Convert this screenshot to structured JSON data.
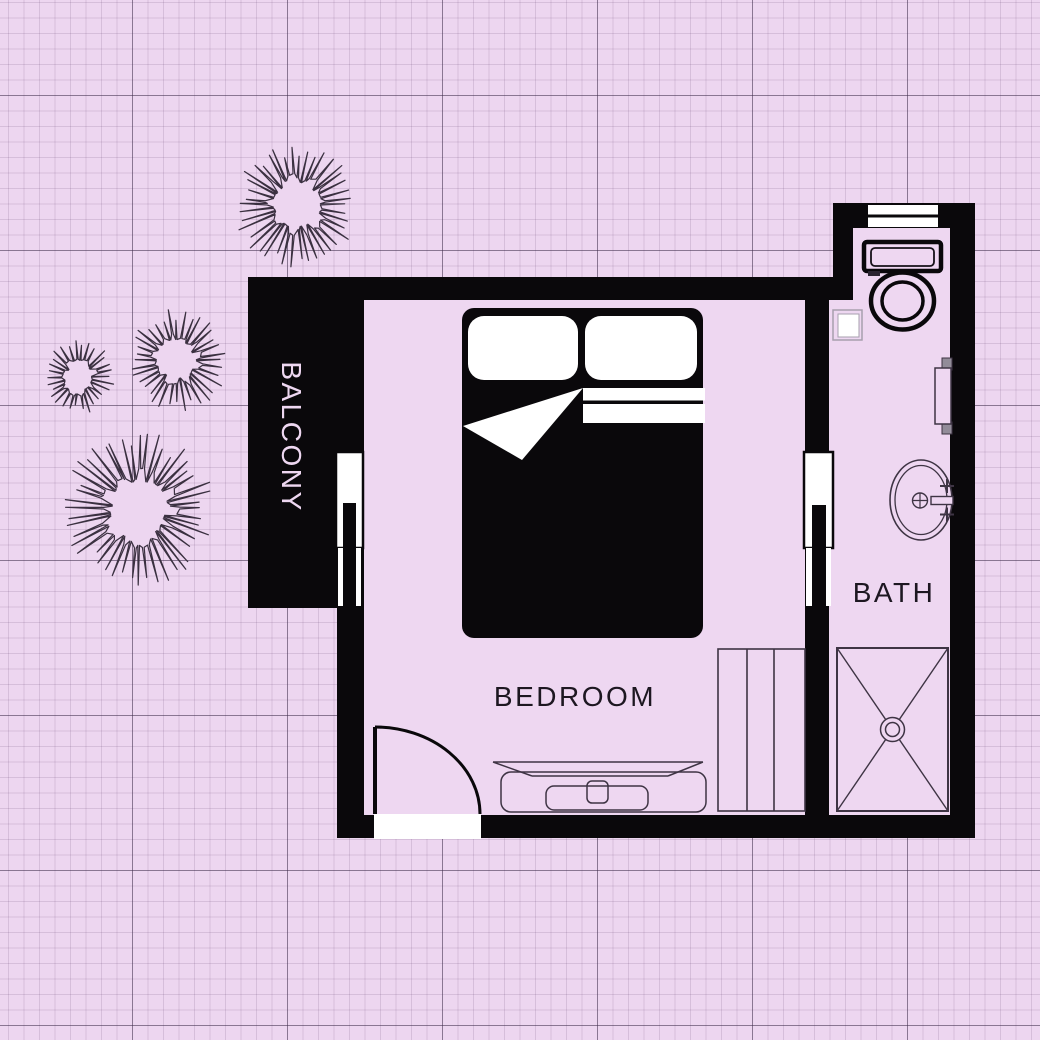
{
  "plan": {
    "labels": {
      "bedroom": "BEDROOM",
      "bath": "BATH",
      "balcony": "BALCONY"
    }
  },
  "colors": {
    "background": "#edd6f0",
    "wall": "#0a080b",
    "room_fill": "#eed7f1",
    "white": "#ffffff",
    "fixture_line": "#3e3444",
    "label_text": "#1d1721",
    "balcony_text": "#eed7f1",
    "bracket_gray": "#928c99",
    "switch_outline": "#a79fae"
  }
}
